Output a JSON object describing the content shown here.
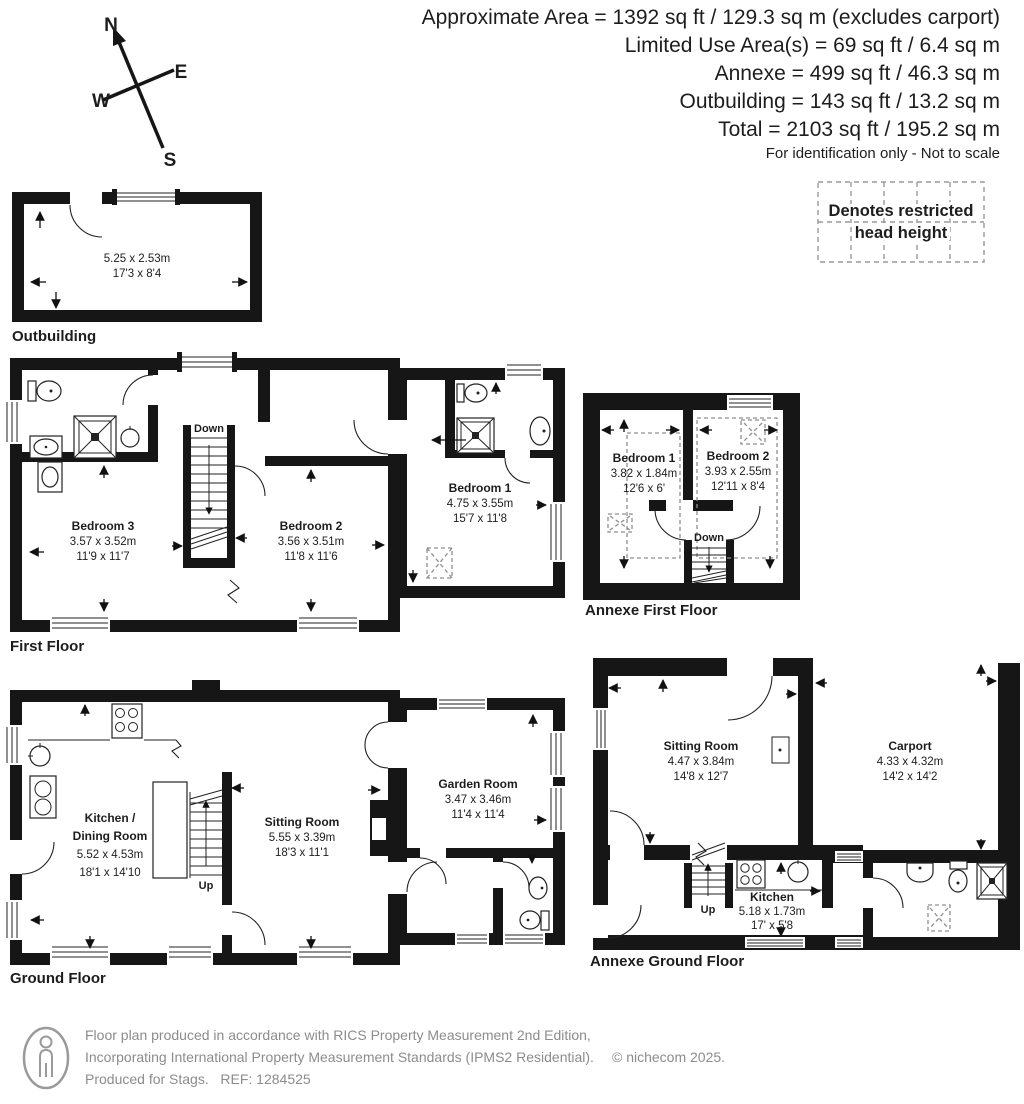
{
  "header": {
    "area_lines": [
      "Approximate Area = 1392 sq ft / 129.3 sq m (excludes carport)",
      "Limited Use Area(s) = 69 sq ft / 6.4 sq m",
      "Annexe = 499 sq ft / 46.3 sq m",
      "Outbuilding = 143 sq ft / 13.2 sq m",
      "Total = 2103 sq ft / 195.2 sq m"
    ],
    "disclaimer": "For identification only - Not to scale"
  },
  "compass": {
    "north": "N",
    "east": "E",
    "south": "S",
    "west": "W"
  },
  "legend": {
    "line1": "Denotes restricted",
    "line2": "head height"
  },
  "outbuilding": {
    "label": "Outbuilding",
    "dims_m": "5.25 x 2.53m",
    "dims_ft": "17'3 x 8'4"
  },
  "first_floor": {
    "label": "First Floor",
    "stairs_label": "Down",
    "bedroom3_name": "Bedroom 3",
    "bedroom3_m": "3.57 x 3.52m",
    "bedroom3_ft": "11'9 x 11'7",
    "bedroom2_name": "Bedroom 2",
    "bedroom2_m": "3.56 x 3.51m",
    "bedroom2_ft": "11'8 x 11'6",
    "bedroom1_name": "Bedroom 1",
    "bedroom1_m": "4.75 x 3.55m",
    "bedroom1_ft": "15'7 x 11'8"
  },
  "annexe_first_floor": {
    "label": "Annexe First Floor",
    "stairs_label": "Down",
    "bedroom1_name": "Bedroom 1",
    "bedroom1_m": "3.82 x 1.84m",
    "bedroom1_ft": "12'6 x 6'",
    "bedroom2_name": "Bedroom 2",
    "bedroom2_m": "3.93 x 2.55m",
    "bedroom2_ft": "12'11 x 8'4"
  },
  "ground_floor": {
    "label": "Ground Floor",
    "stairs_label": "Up",
    "kitchen_name_line1": "Kitchen /",
    "kitchen_name_line2": "Dining Room",
    "kitchen_m": "5.52 x 4.53m",
    "kitchen_ft": "18'1 x 14'10",
    "sitting_name": "Sitting Room",
    "sitting_m": "5.55 x 3.39m",
    "sitting_ft": "18'3 x 11'1",
    "garden_name": "Garden Room",
    "garden_m": "3.47 x 3.46m",
    "garden_ft": "11'4 x 11'4"
  },
  "annexe_ground_floor": {
    "label": "Annexe Ground Floor",
    "stairs_label": "Up",
    "sitting_name": "Sitting Room",
    "sitting_m": "4.47 x 3.84m",
    "sitting_ft": "14'8 x 12'7",
    "carport_name": "Carport",
    "carport_m": "4.33 x 4.32m",
    "carport_ft": "14'2 x 14'2",
    "kitchen_name": "Kitchen",
    "kitchen_m": "5.18 x 1.73m",
    "kitchen_ft": "17' x 5'8"
  },
  "footer": {
    "line1": "Floor plan produced in accordance with RICS Property Measurement 2nd Edition,",
    "line2": "Incorporating International Property Measurement Standards (IPMS2 Residential).",
    "line3": "Produced for Stags.   REF: 1284525",
    "copyright": "© nichecom 2025."
  },
  "colors": {
    "wall": "#161616",
    "text": "#1d1d1d",
    "footer_text": "#8c8c8c",
    "dash": "#8f8f8f"
  }
}
